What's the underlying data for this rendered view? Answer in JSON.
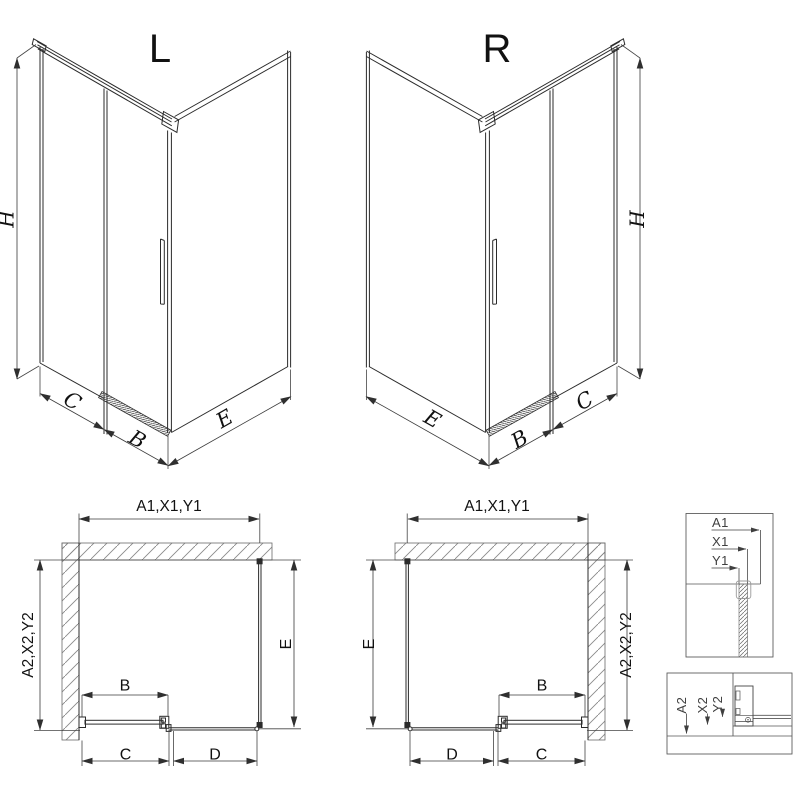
{
  "drawing": {
    "background": "#ffffff",
    "line_color": "#2b2b2b",
    "dim_line_color": "#3a3a3a",
    "hatch_color": "#8a8a8a",
    "text_color": "#111111"
  },
  "view3d_left": {
    "title": "L",
    "dim_h": "H",
    "dim_c": "C",
    "dim_b": "B",
    "dim_e": "E"
  },
  "view3d_right": {
    "title": "R",
    "dim_h": "H",
    "dim_c": "C",
    "dim_b": "B",
    "dim_e": "E"
  },
  "plan_left": {
    "dim_width": "A1,X1,Y1",
    "dim_depth": "A2,X2,Y2",
    "dim_e": "E",
    "dim_b": "B",
    "dim_c": "C",
    "dim_d": "D"
  },
  "plan_right": {
    "dim_width": "A1,X1,Y1",
    "dim_depth": "A2,X2,Y2",
    "dim_e": "E",
    "dim_b": "B",
    "dim_c": "C",
    "dim_d": "D"
  },
  "detail_top": {
    "dim_a1": "A1",
    "dim_x1": "X1",
    "dim_y1": "Y1"
  },
  "detail_bottom": {
    "dim_a2": "A2",
    "dim_x2": "X2",
    "dim_y2": "Y2"
  }
}
